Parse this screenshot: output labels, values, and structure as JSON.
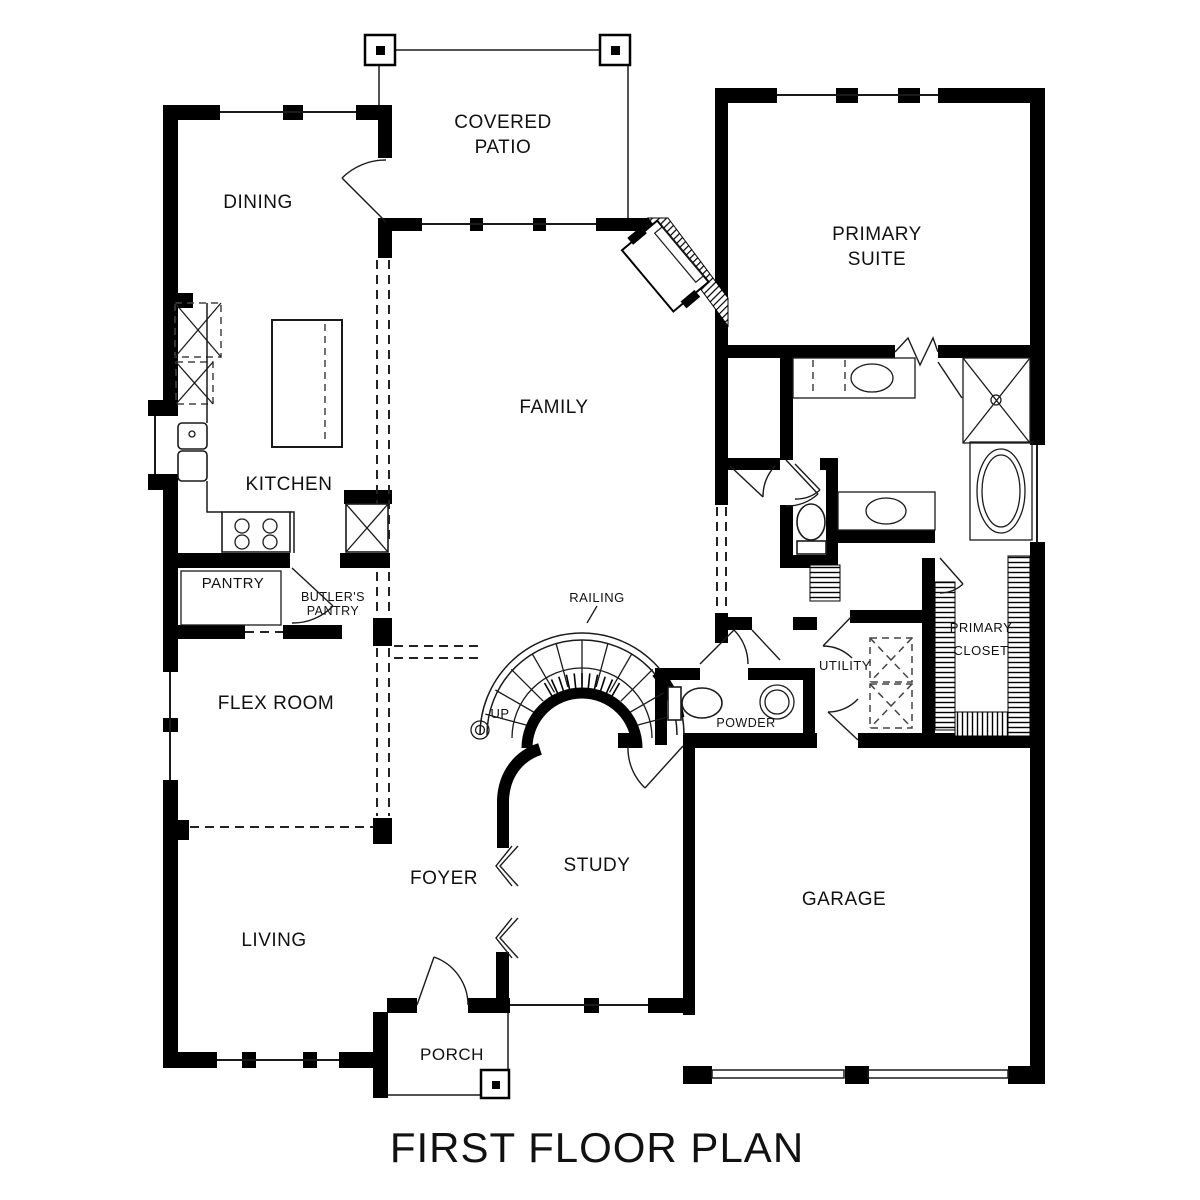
{
  "title": {
    "text": "FIRST FLOOR PLAN"
  },
  "colors": {
    "wall": "#000000",
    "line": "#1a1a1a",
    "label": "#111111",
    "background": "#ffffff"
  },
  "rooms": {
    "dining": {
      "label": "DINING"
    },
    "covered_patio": {
      "line1": "COVERED",
      "line2": "PATIO"
    },
    "primary_suite": {
      "line1": "PRIMARY",
      "line2": "SUITE"
    },
    "family": {
      "label": "FAMILY"
    },
    "kitchen": {
      "label": "KITCHEN"
    },
    "pantry": {
      "label": "PANTRY"
    },
    "butlers_pantry": {
      "line1": "BUTLER'S",
      "line2": "PANTRY"
    },
    "flex_room": {
      "label": "FLEX ROOM"
    },
    "living": {
      "label": "LIVING"
    },
    "foyer": {
      "label": "FOYER"
    },
    "study": {
      "label": "STUDY"
    },
    "garage": {
      "label": "GARAGE"
    },
    "porch": {
      "label": "PORCH"
    },
    "primary_bath": {
      "line1": "PRIMARY",
      "line2": "BATH"
    },
    "primary_closet": {
      "line1": "PRIMARY",
      "line2": "CLOSET"
    },
    "utility": {
      "label": "UTILITY"
    },
    "powder": {
      "label": "POWDER"
    }
  },
  "stairs": {
    "railing_label": "RAILING",
    "up_label": "UP"
  }
}
